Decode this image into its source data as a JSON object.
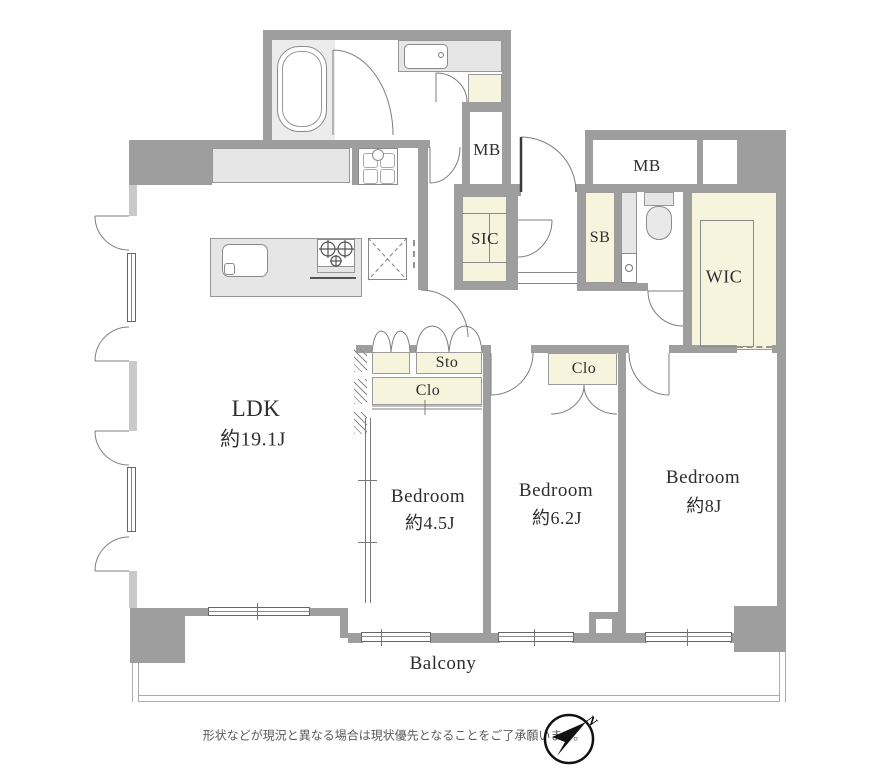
{
  "plan": {
    "ldk": {
      "label": "LDK",
      "area": "約19.1J"
    },
    "bedroom_small": {
      "label": "Bedroom",
      "area": "約4.5J"
    },
    "bedroom_mid": {
      "label": "Bedroom",
      "area": "約6.2J"
    },
    "bedroom_large": {
      "label": "Bedroom",
      "area": "約8J"
    },
    "balcony": {
      "label": "Balcony"
    },
    "wic": {
      "label": "WIC"
    },
    "sic": {
      "label": "SIC"
    },
    "sb": {
      "label": "SB"
    },
    "mb_left": {
      "label": "MB"
    },
    "mb_right": {
      "label": "MB"
    },
    "sto": {
      "label": "Sto"
    },
    "clo_small": {
      "label": "Clo"
    },
    "clo_mid": {
      "label": "Clo"
    }
  },
  "footer": {
    "disclaimer": "形状などが現況と異なる場合は現状優先となることをご了承願います。"
  },
  "compass": {
    "north_label": "N"
  },
  "colors": {
    "wall": "#9e9e9e",
    "closet_fill": "#f7f4dd",
    "fixture_fill": "#e6e6e6"
  }
}
